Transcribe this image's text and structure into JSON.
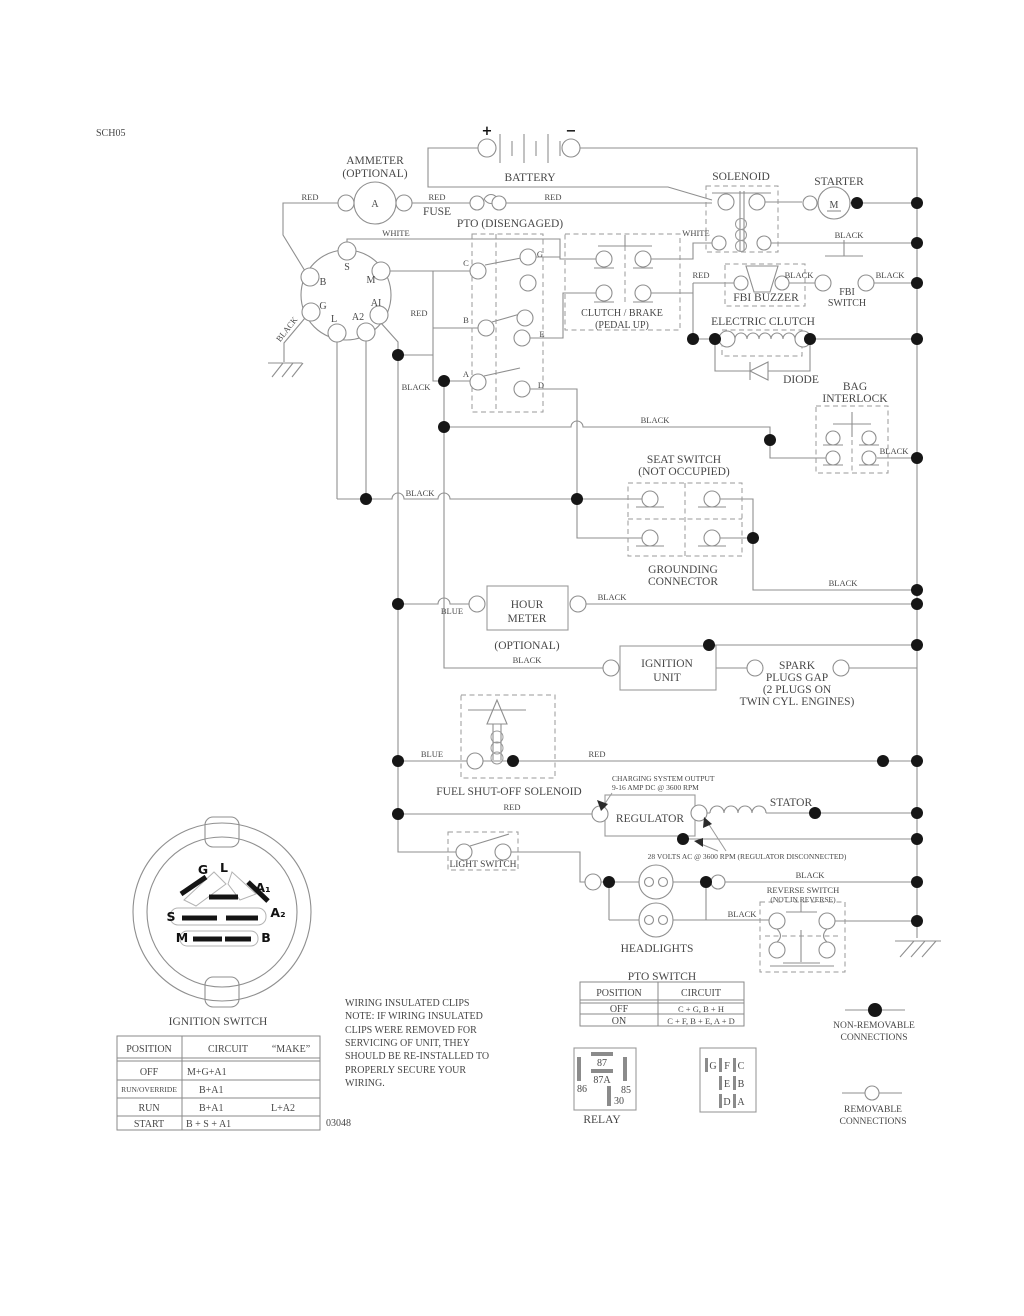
{
  "sheet": {
    "code": "SCH05",
    "number": "03048"
  },
  "w": {
    "red": "RED",
    "black": "BLACK",
    "white": "WHITE",
    "blue": "BLUE"
  },
  "c": {
    "ammeter": "AMMETER",
    "ammeter_opt": "(OPTIONAL)",
    "ammeter_sym": "A",
    "battery": "BATTERY",
    "plus": "+",
    "minus": "−",
    "fuse": "FUSE",
    "pto_disengaged": "PTO (DISENGAGED)",
    "solenoid": "SOLENOID",
    "starter": "STARTER",
    "starter_sym": "M",
    "fbi_buzzer": "FBI BUZZER",
    "fbi1": "FBI",
    "fbi2": "SWITCH",
    "cb1": "CLUTCH / BRAKE",
    "cb2": "(PEDAL UP)",
    "eclutch": "ELECTRIC CLUTCH",
    "diode": "DIODE",
    "bag1": "BAG",
    "bag2": "INTERLOCK",
    "seat1": "SEAT SWITCH",
    "seat2": "(NOT OCCUPIED)",
    "gnd1": "GROUNDING",
    "gnd2": "CONNECTOR",
    "hour1": "HOUR",
    "hour2": "METER",
    "hour_opt": "(OPTIONAL)",
    "ign1": "IGNITION",
    "ign2": "UNIT",
    "spark1": "SPARK",
    "spark2": "PLUGS GAP",
    "spark3": "(2 PLUGS ON",
    "spark4": "TWIN CYL. ENGINES)",
    "fuel": "FUEL SHUT-OFF SOLENOID",
    "chg1": "CHARGING SYSTEM OUTPUT",
    "chg2": "9-16 AMP DC @ 3600 RPM",
    "regulator": "REGULATOR",
    "stator": "STATOR",
    "volts": "28 VOLTS AC @ 3600 RPM (REGULATOR DISCONNECTED)",
    "light": "LIGHT SWITCH",
    "headlights": "HEADLIGHTS",
    "rev1": "REVERSE SWITCH",
    "rev2": "(NOT IN REVERSE)",
    "relay": "RELAY"
  },
  "pto": {
    "c": "C",
    "g": "G",
    "b": "B",
    "e": "E",
    "a": "A",
    "d": "D"
  },
  "key": {
    "s": "S",
    "m": "M",
    "b": "B",
    "g": "G",
    "ai": "AI",
    "l": "L",
    "a2": "A2"
  },
  "conn": {
    "title": "IGNITION SWITCH",
    "g": "G",
    "l": "L",
    "a1": "A₁",
    "a2": "A₂",
    "s": "S",
    "m": "M",
    "b": "B"
  },
  "relay_pins": {
    "p87": "87",
    "p87a": "87A",
    "p86": "86",
    "p85": "85",
    "p30": "30"
  },
  "plug": {
    "g": "G",
    "f": "F",
    "c": "C",
    "e": "E",
    "b": "B",
    "d": "D",
    "a": "A"
  },
  "ign_table": {
    "h_pos": "POSITION",
    "h_cir": "CIRCUIT",
    "h_make": "“MAKE”",
    "rows": [
      {
        "pos": "OFF",
        "cir": "M+G+A1",
        "make": ""
      },
      {
        "pos": "RUN/OVERRIDE",
        "cir": "B+A1",
        "make": ""
      },
      {
        "pos": "RUN",
        "cir": "B+A1",
        "make": "L+A2"
      },
      {
        "pos": "START",
        "cir": "B + S + A1",
        "make": ""
      }
    ]
  },
  "pto_table": {
    "title": "PTO SWITCH",
    "h_pos": "POSITION",
    "h_cir": "CIRCUIT",
    "rows": [
      {
        "pos": "OFF",
        "cir": "C + G, B + H"
      },
      {
        "pos": "ON",
        "cir": "C + F, B + E, A + D"
      }
    ]
  },
  "legend": {
    "nr1": "NON-REMOVABLE",
    "nr2": "CONNECTIONS",
    "r1": "REMOVABLE",
    "r2": "CONNECTIONS"
  },
  "note": {
    "l1": "WIRING INSULATED CLIPS",
    "l2": "NOTE:  IF WIRING INSULATED",
    "l3": "CLIPS WERE REMOVED FOR",
    "l4": "SERVICING OF UNIT, THEY",
    "l5": "SHOULD BE RE-INSTALLED TO",
    "l6": "PROPERLY SECURE YOUR",
    "l7": "WIRING."
  }
}
